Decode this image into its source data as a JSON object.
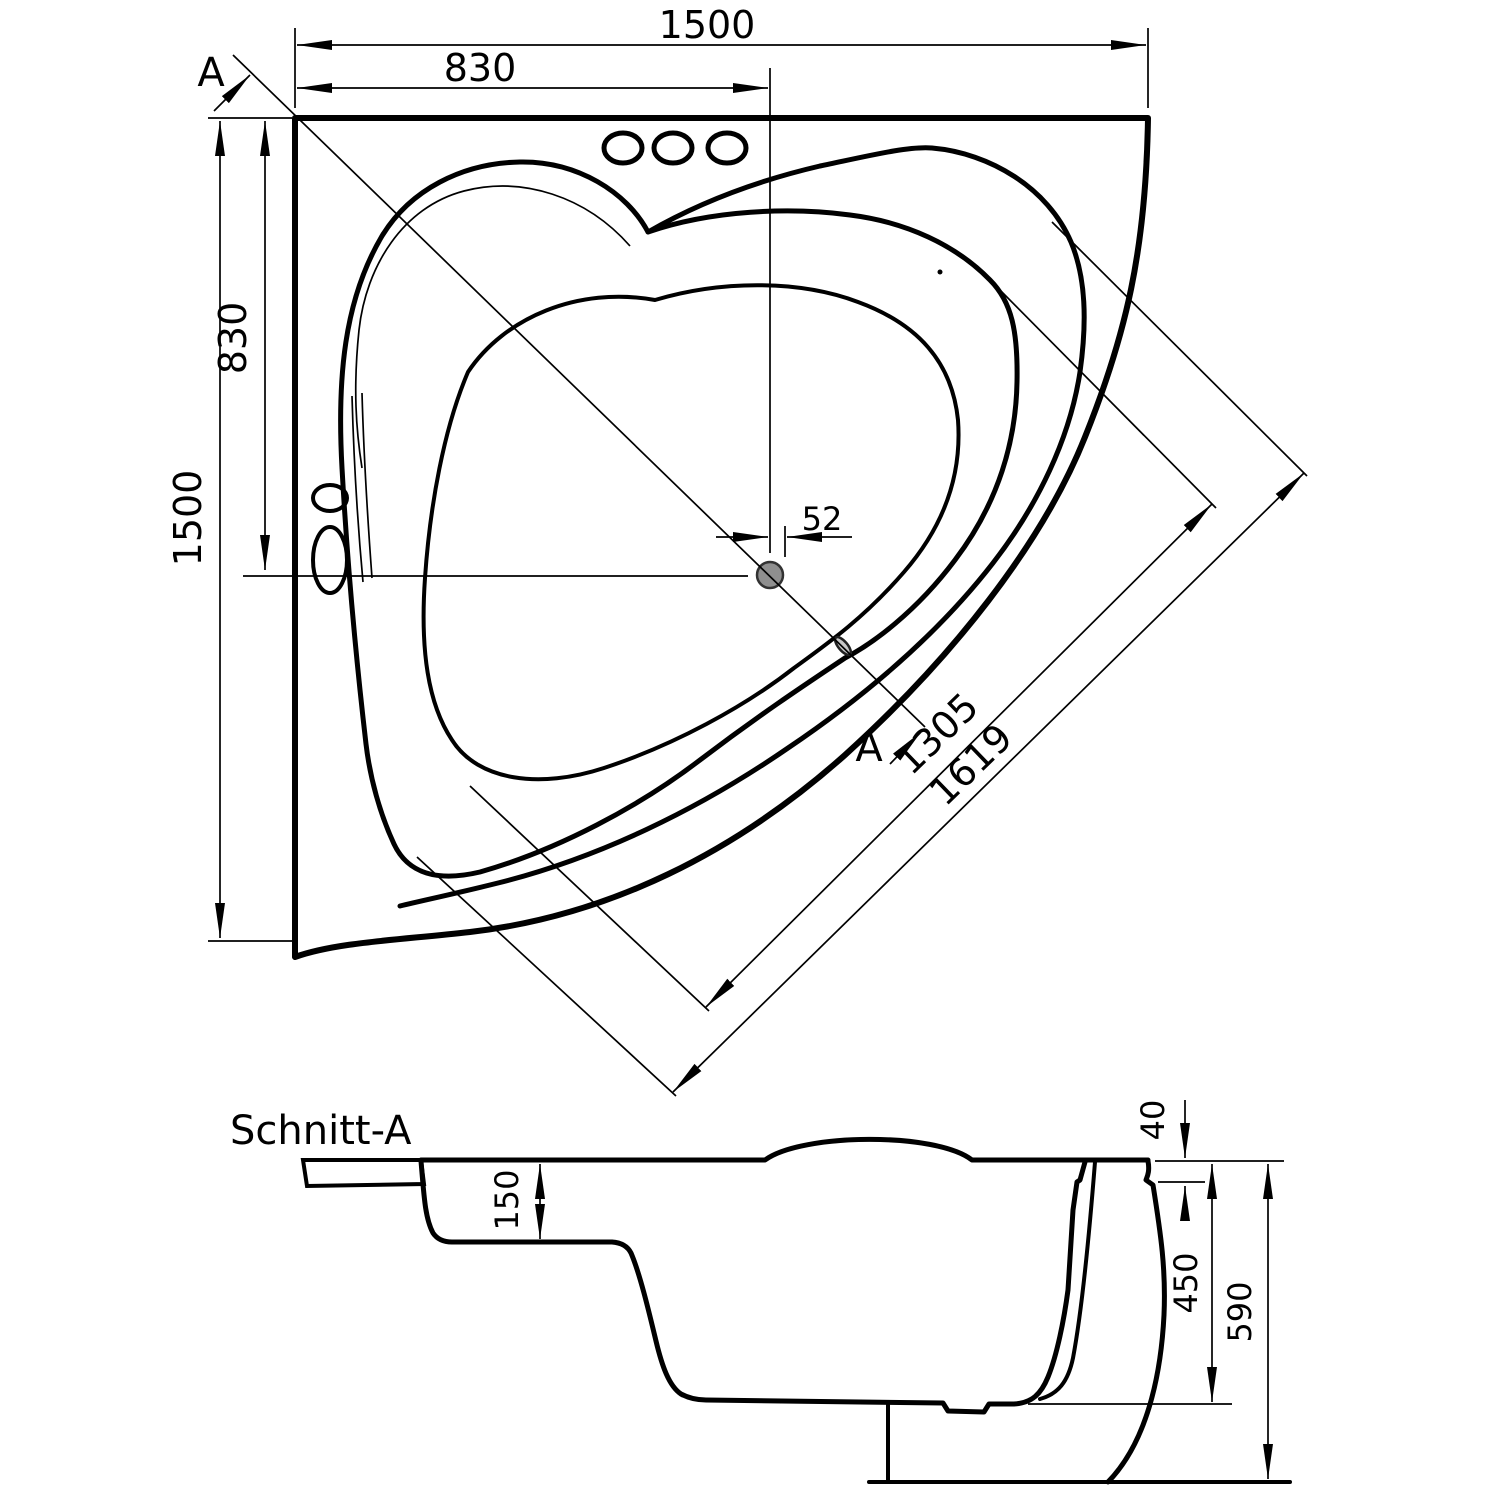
{
  "page": {
    "background": "#ffffff",
    "line_color": "#000000",
    "drain_fill": "#8f8f8f"
  },
  "top_view": {
    "dim_total_width": "1500",
    "dim_width_to_drain": "830",
    "dim_total_height": "1500",
    "dim_height_to_drain": "830",
    "dim_drain_offset": "52",
    "dim_diagonal_inner": "1305",
    "dim_diagonal_outer": "1619",
    "section_marker_start": "A",
    "section_marker_end": "A"
  },
  "section_view": {
    "title": "Schnitt-A",
    "dim_rim_thickness": "40",
    "dim_seat_height": "150",
    "dim_inner_depth": "450",
    "dim_total_height": "590"
  }
}
